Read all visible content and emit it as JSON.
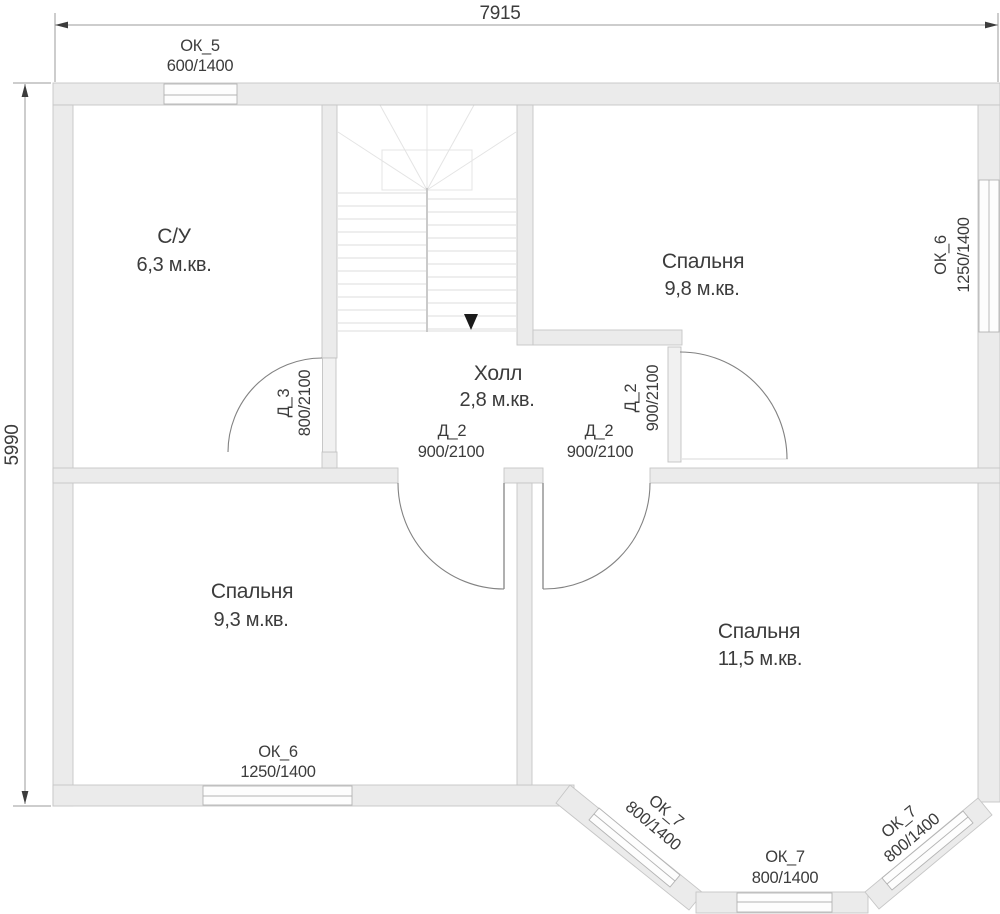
{
  "plan": {
    "dimensions": {
      "width_label": "7915",
      "height_label": "5990"
    },
    "rooms": [
      {
        "name": "С/У",
        "area": "6,3 м.кв."
      },
      {
        "name": "Спальня",
        "area": "9,8 м.кв."
      },
      {
        "name": "Холл",
        "area": "2,8 м.кв."
      },
      {
        "name": "Спальня",
        "area": "9,3 м.кв."
      },
      {
        "name": "Спальня",
        "area": "11,5 м.кв."
      }
    ],
    "windows": [
      {
        "id": "ОК_5",
        "size": "600/1400",
        "location": "top"
      },
      {
        "id": "ОК_6",
        "size": "1250/1400",
        "location": "right"
      },
      {
        "id": "ОК_6",
        "size": "1250/1400",
        "location": "bottom-left"
      },
      {
        "id": "ОК_7",
        "size": "800/1400",
        "location": "bay-left"
      },
      {
        "id": "ОК_7",
        "size": "800/1400",
        "location": "bay-bottom"
      },
      {
        "id": "ОК_7",
        "size": "800/1400",
        "location": "bay-right"
      }
    ],
    "doors": [
      {
        "id": "Д_3",
        "size": "800/2100",
        "location": "bathroom"
      },
      {
        "id": "Д_2",
        "size": "900/2100",
        "location": "bedroom-9-3"
      },
      {
        "id": "Д_2",
        "size": "900/2100",
        "location": "bedroom-11-5"
      },
      {
        "id": "Д_2",
        "size": "900/2100",
        "location": "bedroom-9-8"
      }
    ],
    "colors": {
      "wall_fill": "#ebebeb",
      "text": "#3c3c3c",
      "arrow": "#1a1a1a"
    }
  }
}
